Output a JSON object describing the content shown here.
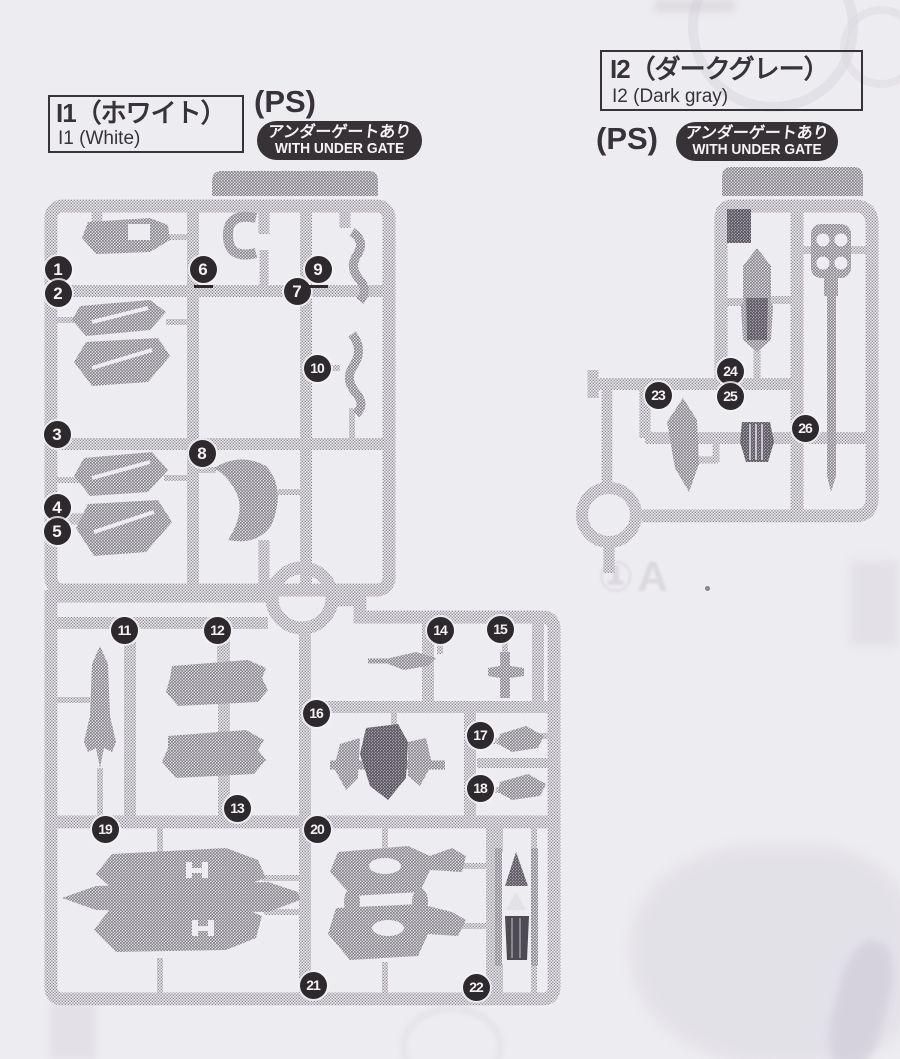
{
  "page": {
    "background_color": "#edecf0",
    "ink_color": "#38333a",
    "badge_bg_color": "#373236",
    "callout_bg_color": "#2e292d"
  },
  "runner_i1": {
    "name_jp": "I1（ホワイト）",
    "name_en": "I1 (White)",
    "material": "(PS)",
    "undergate_jp": "アンダーゲートあり",
    "undergate_en": "WITH UNDER GATE"
  },
  "runner_i2": {
    "name_jp": "I2（ダークグレー）",
    "name_en": "I2 (Dark gray)",
    "material": "(PS)",
    "undergate_jp": "アンダーゲートあり",
    "undergate_en": "WITH UNDER GATE"
  },
  "ghost": {
    "bleed_text": "①A"
  },
  "callouts": [
    {
      "label": "1",
      "x": 58,
      "y": 269,
      "underline": false
    },
    {
      "label": "2",
      "x": 58,
      "y": 293,
      "underline": false
    },
    {
      "label": "3",
      "x": 57,
      "y": 434,
      "underline": false
    },
    {
      "label": "4",
      "x": 57,
      "y": 507,
      "underline": false
    },
    {
      "label": "5",
      "x": 57,
      "y": 531,
      "underline": false
    },
    {
      "label": "6",
      "x": 203,
      "y": 269,
      "underline": true
    },
    {
      "label": "7",
      "x": 297,
      "y": 291,
      "underline": false
    },
    {
      "label": "8",
      "x": 202,
      "y": 453,
      "underline": false
    },
    {
      "label": "9",
      "x": 318,
      "y": 269,
      "underline": true
    },
    {
      "label": "10",
      "x": 317,
      "y": 368,
      "underline": false
    },
    {
      "label": "11",
      "x": 124,
      "y": 630,
      "underline": false
    },
    {
      "label": "12",
      "x": 217,
      "y": 630,
      "underline": false
    },
    {
      "label": "13",
      "x": 237,
      "y": 808,
      "underline": false
    },
    {
      "label": "14",
      "x": 440,
      "y": 630,
      "underline": false
    },
    {
      "label": "15",
      "x": 500,
      "y": 629,
      "underline": false
    },
    {
      "label": "16",
      "x": 316,
      "y": 713,
      "underline": false
    },
    {
      "label": "17",
      "x": 480,
      "y": 735,
      "underline": false
    },
    {
      "label": "18",
      "x": 480,
      "y": 788,
      "underline": false
    },
    {
      "label": "19",
      "x": 105,
      "y": 829,
      "underline": false
    },
    {
      "label": "20",
      "x": 317,
      "y": 829,
      "underline": false
    },
    {
      "label": "21",
      "x": 313,
      "y": 985,
      "underline": false
    },
    {
      "label": "22",
      "x": 476,
      "y": 987,
      "underline": false
    },
    {
      "label": "23",
      "x": 658,
      "y": 395,
      "underline": false
    },
    {
      "label": "24",
      "x": 730,
      "y": 371,
      "underline": false
    },
    {
      "label": "25",
      "x": 730,
      "y": 396,
      "underline": false
    },
    {
      "label": "26",
      "x": 805,
      "y": 428,
      "underline": false
    }
  ]
}
